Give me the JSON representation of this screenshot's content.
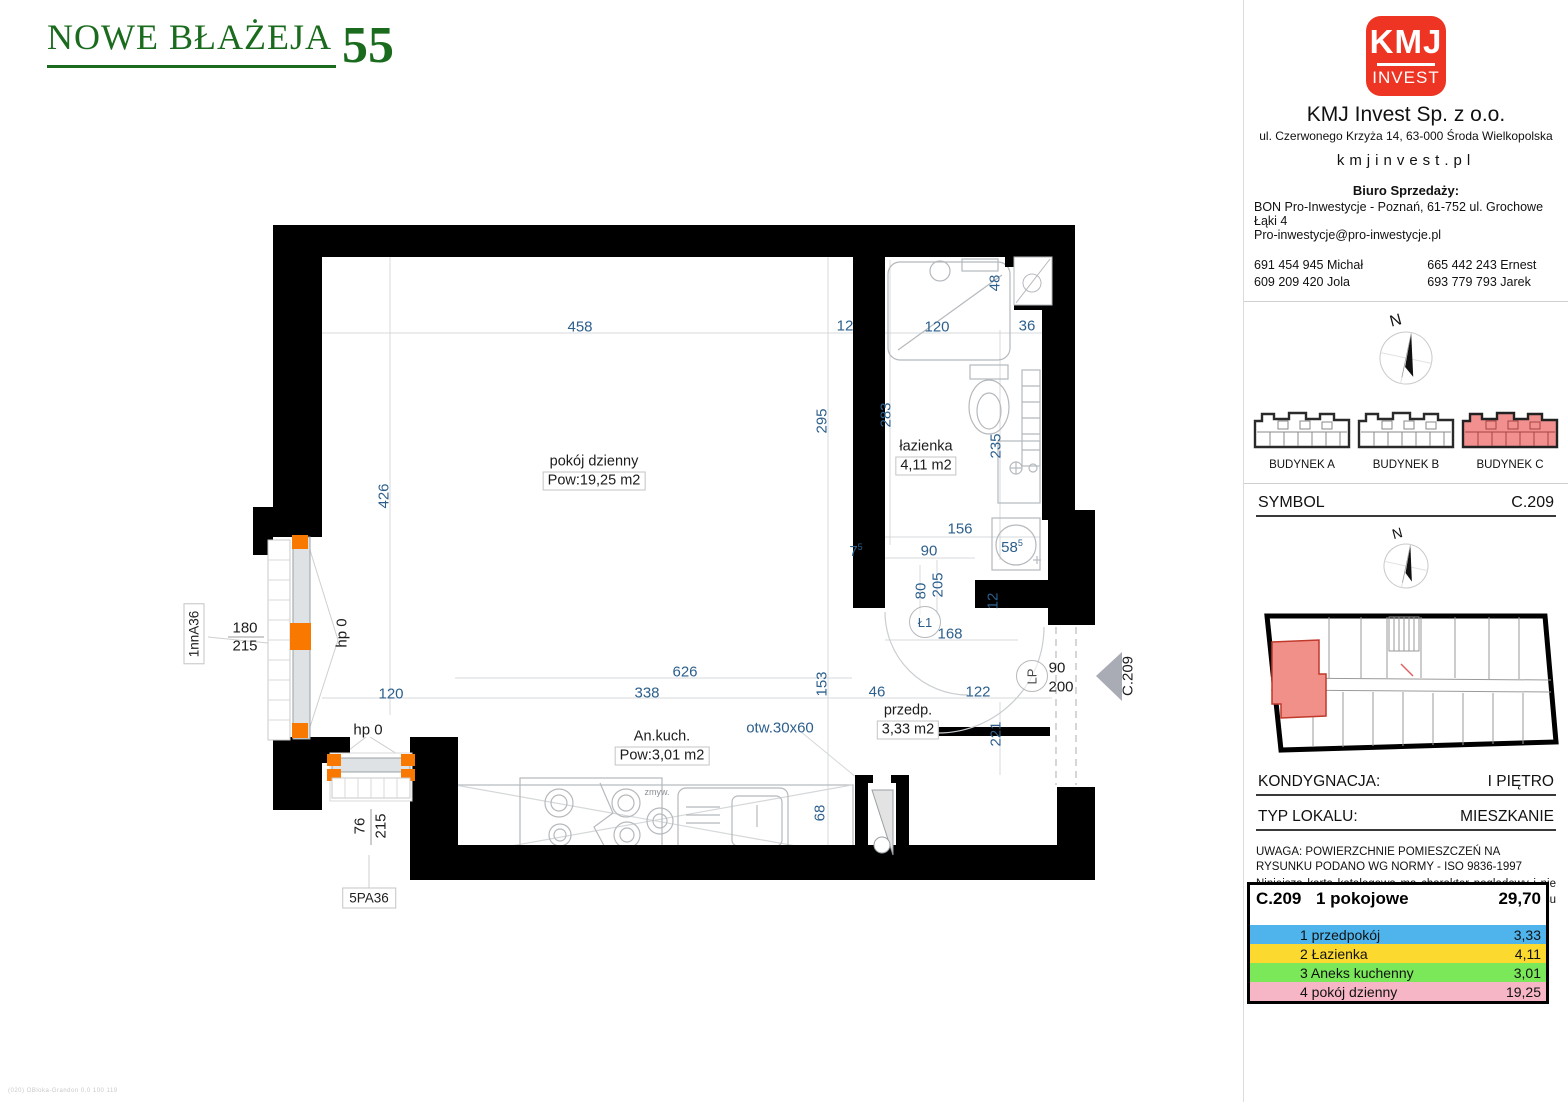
{
  "header": {
    "project_name": "NOWE BŁAŻEJA",
    "project_number": "55"
  },
  "colors": {
    "brand_green": "#1a6b1e",
    "logo_red": "#ee3422",
    "window_orange": "#f87800",
    "dim_blue": "#2c5f8c",
    "unit_highlight_red": "#f19089"
  },
  "sidebar": {
    "logo": {
      "line1": "KMJ",
      "line2": "INVEST"
    },
    "company_name": "KMJ Invest Sp. z o.o.",
    "company_address": "ul. Czerwonego Krzyża 14, 63-000 Środa Wielkopolska",
    "website": "kmjinvest.pl",
    "sales_office_title": "Biuro Sprzedaży:",
    "sales_office_line1": "BON Pro-Inwestycje - Poznań, 61-752 ul. Grochowe Łąki 4",
    "sales_office_line2": "Pro-inwestycje@pro-inwestycje.pl",
    "phones": [
      {
        "number": "691 454 945",
        "name": "Michał"
      },
      {
        "number": "665 442 243",
        "name": "Ernest"
      },
      {
        "number": "609 209 420",
        "name": "Jola"
      },
      {
        "number": "693 779 793",
        "name": "Jarek"
      }
    ],
    "compass_label": "N",
    "buildings": [
      {
        "label": "BUDYNEK A",
        "highlighted": false
      },
      {
        "label": "BUDYNEK B",
        "highlighted": false
      },
      {
        "label": "BUDYNEK C",
        "highlighted": true
      }
    ],
    "symbol_label": "SYMBOL",
    "symbol_value": "C.209",
    "floor_label": "KONDYGNACJA:",
    "floor_value": "I PIĘTRO",
    "type_label": "TYP LOKALU:",
    "type_value": "MIESZKANIE",
    "disclaimer_line1": "UWAGA: POWIERZCHNIE POMIESZCZEŃ NA RYSUNKU PODANO WG NORMY - ISO 9836-1997",
    "disclaimer_line2": "Niniejsza karta katalogowa ma charakter poglądowy i nie stanowi oferty w rozumieniu przepisów Kodeksu Cywilnego"
  },
  "area_table": {
    "symbol": "C.209",
    "unit_type": "1 pokojowe",
    "total_area": "29,70",
    "rows": [
      {
        "num": "1",
        "room": "przedpokój",
        "area": "3,33",
        "color": "#4fb4ec"
      },
      {
        "num": "2",
        "room": "Łazienka",
        "area": "4,11",
        "color": "#fbd92f"
      },
      {
        "num": "3",
        "room": "Aneks kuchenny",
        "area": "3,01",
        "color": "#7be85a"
      },
      {
        "num": "4",
        "room": "pokój dzienny",
        "area": "19,25",
        "color": "#f7b6c6"
      }
    ]
  },
  "plan": {
    "rooms": [
      {
        "name": "pokój dzienny",
        "area": "Pow:19,25 m2",
        "x": 414,
        "y": 257
      },
      {
        "name": "łazienka",
        "area": "4,11 m2",
        "x": 746,
        "y": 242
      },
      {
        "name": "An.kuch.",
        "area": "Pow:3,01 m2",
        "x": 482,
        "y": 532
      },
      {
        "name": "przedp.",
        "area": "3,33 m2",
        "x": 728,
        "y": 506
      }
    ],
    "tags": {
      "window_left": "1nnA36",
      "window_bottom": "5PA36",
      "door_bath": "Ł1",
      "door_entry": "LP",
      "entry_symbol": "C.209"
    },
    "dims": [
      {
        "t": "458",
        "x": 400,
        "y": 112
      },
      {
        "t": "12",
        "x": 665,
        "y": 111
      },
      {
        "t": "120",
        "x": 757,
        "y": 112
      },
      {
        "t": "36",
        "x": 847,
        "y": 111
      },
      {
        "t": "48",
        "x": 815,
        "y": 68,
        "r": 1
      },
      {
        "t": "295",
        "x": 642,
        "y": 206,
        "r": 1
      },
      {
        "t": "283",
        "x": 706,
        "y": 200,
        "r": 1
      },
      {
        "t": "235",
        "x": 816,
        "y": 231,
        "r": 1
      },
      {
        "t": "426",
        "x": 204,
        "y": 281,
        "r": 1
      },
      {
        "t": "156",
        "x": 780,
        "y": 314
      },
      {
        "t": "90",
        "x": 749,
        "y": 336
      },
      {
        "t": "58",
        "sup": "5",
        "x": 832,
        "y": 332
      },
      {
        "t": "7",
        "sup": "5",
        "x": 676,
        "y": 336
      },
      {
        "t": "80",
        "x": 741,
        "y": 376,
        "r": 1
      },
      {
        "t": "205",
        "x": 758,
        "y": 370,
        "r": 1
      },
      {
        "t": "12",
        "x": 813,
        "y": 386,
        "r": 1
      },
      {
        "t": "168",
        "x": 770,
        "y": 419
      },
      {
        "t": "626",
        "x": 505,
        "y": 457
      },
      {
        "t": "338",
        "x": 467,
        "y": 478
      },
      {
        "t": "120",
        "x": 211,
        "y": 479
      },
      {
        "t": "153",
        "x": 642,
        "y": 469,
        "r": 1
      },
      {
        "t": "46",
        "x": 697,
        "y": 477
      },
      {
        "t": "122",
        "x": 798,
        "y": 477
      },
      {
        "t": "221",
        "x": 816,
        "y": 519,
        "r": 1
      },
      {
        "t": "68",
        "x": 640,
        "y": 598,
        "r": 1
      },
      {
        "t": "otw.30x60",
        "x": 600,
        "y": 513
      },
      {
        "t": "90",
        "x": 877,
        "y": 453,
        "c": "k"
      },
      {
        "t": "200",
        "x": 881,
        "y": 472,
        "c": "k"
      },
      {
        "t": "hp 0",
        "x": 188,
        "y": 515,
        "c": "k"
      },
      {
        "t": "hp 0",
        "x": 162,
        "y": 418,
        "r": 1,
        "c": "k"
      },
      {
        "t": "180",
        "x": 65,
        "y": 413,
        "c": "k"
      },
      {
        "t": "215",
        "x": 65,
        "y": 431,
        "c": "k"
      },
      {
        "t": "76",
        "x": 180,
        "y": 611,
        "r": 1,
        "c": "k"
      },
      {
        "t": "215",
        "x": 201,
        "y": 611,
        "r": 1,
        "c": "k"
      },
      {
        "t": "zmyw.",
        "x": 477,
        "y": 577,
        "c": "sm"
      },
      {
        "t": "C.209",
        "x": 948,
        "y": 461,
        "r": 1,
        "c": "k"
      }
    ]
  },
  "stamp": "(020) OBloka-Grandon 0.0 100 119"
}
